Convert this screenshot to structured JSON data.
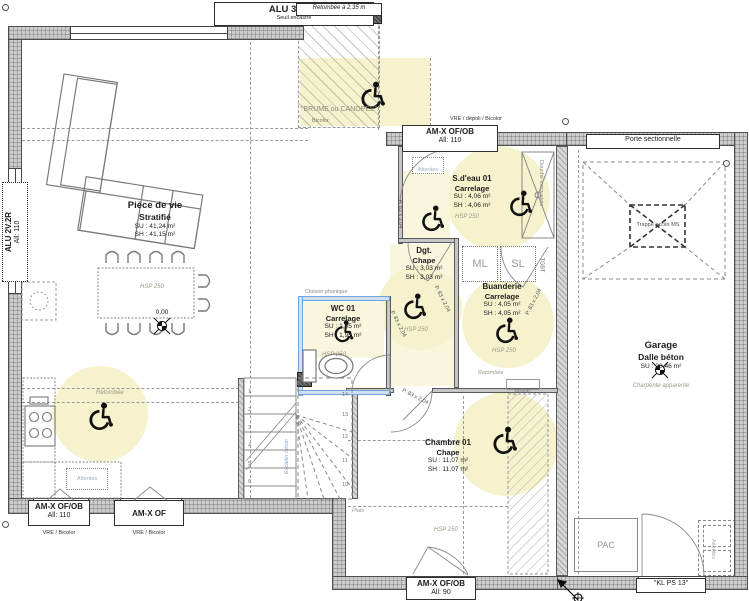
{
  "palette": {
    "wall_gray": "#cccccc",
    "accent_yellow": "#f6f2cd",
    "phonic_blue": "#74a3d6",
    "muted": "#9a9a8a"
  },
  "rooms": {
    "piece_de_vie": {
      "name": "Pièce de vie",
      "finish": "Stratifié",
      "su": "SU : 41,24 m²",
      "sh": "SH : 41,15 m²"
    },
    "sdeau": {
      "name": "S.d'eau 01",
      "finish": "Carrelage",
      "su": "SU : 4,06 m²",
      "sh": "SH : 4,06 m²"
    },
    "dgt": {
      "name": "Dgt.",
      "finish": "Chape",
      "su": "SU : 3,03 m²",
      "sh": "SH : 3,03 m²"
    },
    "wc": {
      "name": "WC 01",
      "finish": "Carrelage",
      "su": "SU : 1,95 m²",
      "sh": "SH : 1,95 m²"
    },
    "buanderie": {
      "name": "Buanderie",
      "finish": "Carrelage",
      "su": "SU : 4,05 m²",
      "sh": "SH : 4,05 m²"
    },
    "chambre": {
      "name": "Chambre 01",
      "finish": "Chape",
      "su": "SU : 11,07 m²",
      "sh": "SH : 11,07 m²"
    },
    "garage": {
      "name": "Garage",
      "finish": "Dalle béton",
      "su": "SU : 20,46 m²",
      "note": "Charpente apparente"
    }
  },
  "openings": {
    "top_bay": {
      "l1": "ALU 3V.3R.",
      "l2": "Seuil encastré"
    },
    "left_bay": {
      "l1": "ALU 2V.2R",
      "l2": "All: 110"
    },
    "entry": {
      "over": "VRE / dépoli / Bicolor",
      "l1": "AM-X OF/OB",
      "l2": "All: 110"
    },
    "garage_door": "Porte sectionnelle",
    "kitchen_win": {
      "l1": "AM-X OF/OB",
      "l2": "All: 110",
      "under": "VRE / Bicolor"
    },
    "kitchen_win2": {
      "l1": "AM-X OF",
      "under": "VRE / Bicolor"
    },
    "bedroom_win": {
      "l1": "AM-X OF/OB",
      "l2": "All: 90"
    },
    "side_door": "\"KL PS 13\"",
    "door_size": "P. 83 x 2,04"
  },
  "annotations": {
    "retombee_haut": "Retombée à 2,35 m",
    "fx_plafond": "Fx Plafond PVC blanc",
    "brume": "\"BRUME ou CANOPEE\"",
    "bicolor": "Bicolor",
    "cloison": "Cloison phonique",
    "ml": "ML",
    "sl": "SL",
    "tgbt": "TGBT",
    "attentes": "Attentes",
    "pac": "PAC",
    "plomb": "Plomb.",
    "plats": "Plats",
    "retombee": "Retombée",
    "trappe": "Trappe accès MS",
    "douche": "Douche extra-plate",
    "escalier": "Escalier béton",
    "hsp": "HSP 250",
    "level": "0,00"
  },
  "stairs": {
    "left": [
      "1",
      "2",
      "3",
      "4",
      "5",
      "6"
    ],
    "right": [
      "14",
      "13",
      "12",
      "11",
      "10"
    ]
  }
}
